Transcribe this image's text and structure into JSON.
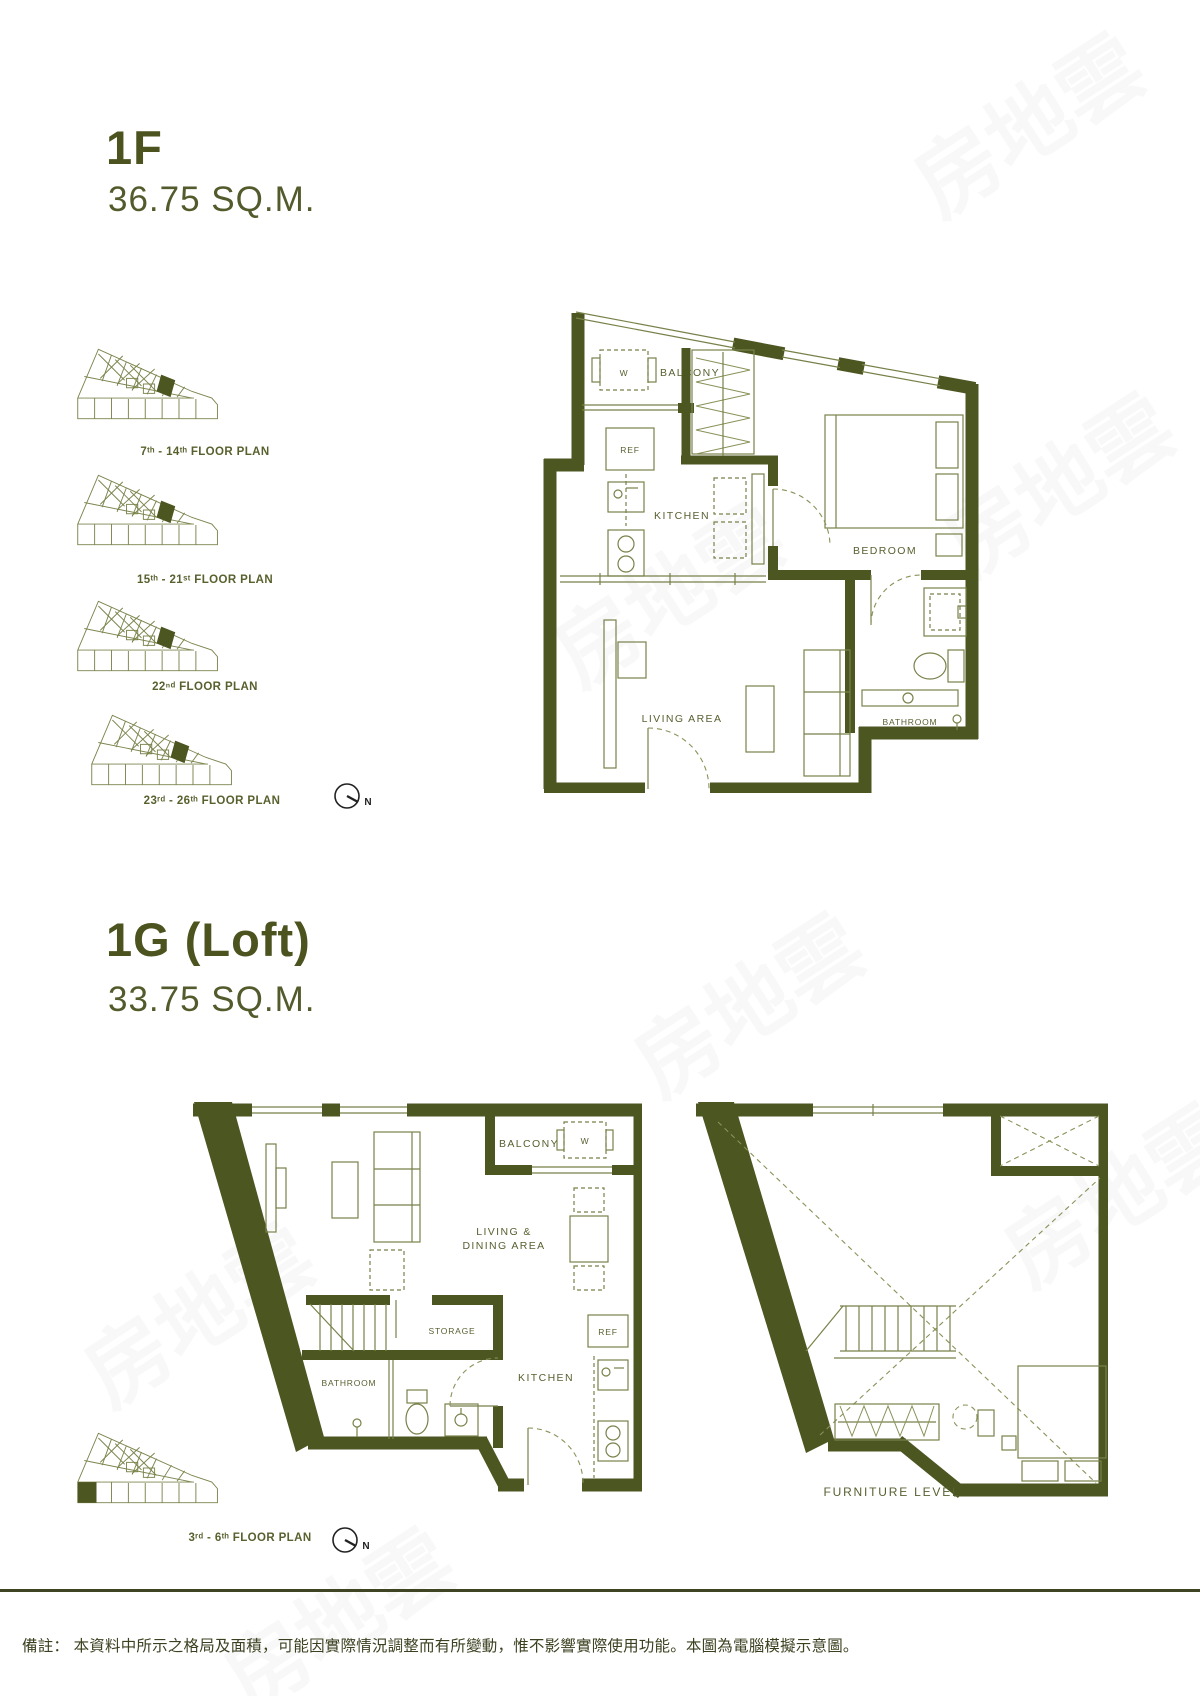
{
  "page": {
    "width": 1200,
    "height": 1696,
    "background": "#ffffff"
  },
  "colors": {
    "accent": "#4c531f",
    "wall": "#4c5621",
    "furniture_line": "#78814a",
    "label": "#576030",
    "note": "#3b4120",
    "rule": "#3f4522"
  },
  "watermark": {
    "text": "房地雲"
  },
  "sections": [
    {
      "unit": "1F",
      "area": "36.75 SQ.M.",
      "key_plans": [
        {
          "label": "7ᵗʰ - 14ᵗʰ FLOOR PLAN"
        },
        {
          "label": "15ᵗʰ - 21ˢᵗ FLOOR PLAN"
        },
        {
          "label": "22ⁿᵈ FLOOR PLAN"
        },
        {
          "label": "23ʳᵈ - 26ᵗʰ FLOOR PLAN"
        }
      ],
      "compass": "N",
      "rooms": {
        "balcony": "BALCONY",
        "washer": "W",
        "ref": "REF",
        "kitchen": "KITCHEN",
        "bedroom": "BEDROOM",
        "living": "LIVING AREA",
        "bathroom": "BATHROOM"
      }
    },
    {
      "unit": "1G (Loft)",
      "area": "33.75 SQ.M.",
      "key_plans": [
        {
          "label": "3ʳᵈ - 6ᵗʰ FLOOR PLAN"
        }
      ],
      "compass": "N",
      "lower_rooms": {
        "balcony": "BALCONY",
        "washer": "W",
        "living1": "LIVING &",
        "living2": "DINING AREA",
        "storage": "STORAGE",
        "bathroom": "BATHROOM",
        "kitchen": "KITCHEN",
        "ref": "REF"
      },
      "upper_label": "FURNITURE LEVEL"
    }
  ],
  "footnote": "備註： 本資料中所示之格局及面積，可能因實際情況調整而有所變動，惟不影響實際使用功能。本圖為電腦模擬示意圖。"
}
